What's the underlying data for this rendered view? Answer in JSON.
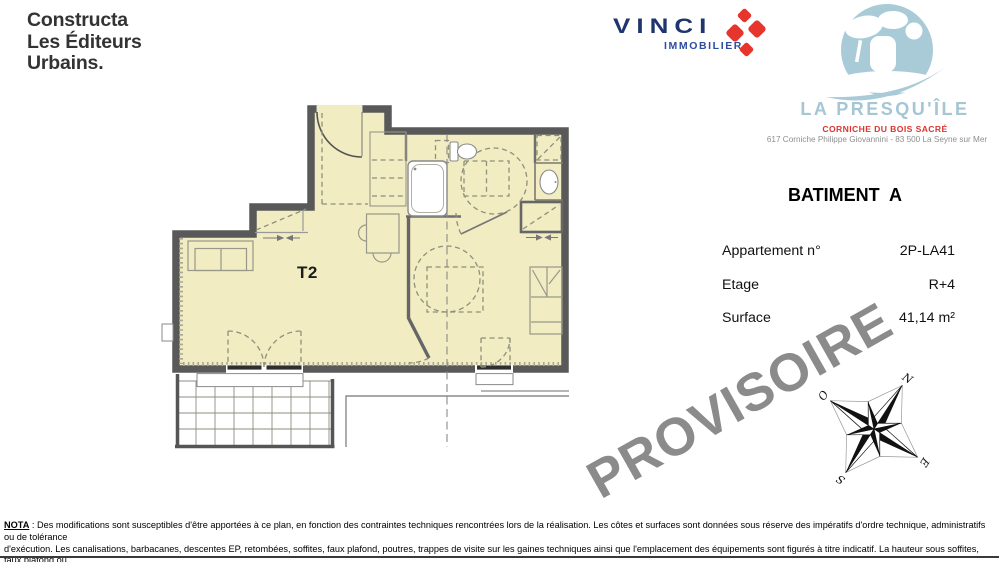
{
  "header": {
    "constructa": {
      "lines": [
        "Constructa",
        "Les Éditeurs",
        "Urbains."
      ]
    },
    "vinci": {
      "name": "VINCI",
      "subtitle": "IMMOBILIER"
    },
    "presquile": {
      "name": "LA PRESQU'ÎLE",
      "tagline": "CORNICHE DU BOIS SACRÉ",
      "address": "617 Corniche Philippe Giovannini - 83 500 La Seyne sur Mer"
    }
  },
  "building": {
    "title": "BATIMENT  A"
  },
  "details": {
    "rows": [
      {
        "label": "Appartement n°",
        "value": "2P-LA41"
      },
      {
        "label": "Etage",
        "value": "R+4"
      },
      {
        "label": "Surface",
        "value": "41,14 m²"
      }
    ]
  },
  "plan": {
    "unit_label": "T2"
  },
  "watermark": {
    "text": "PROVISOIRE"
  },
  "compass": {
    "n": "N",
    "e": "E",
    "s": "S",
    "o": "O"
  },
  "nota": {
    "label": "NOTA",
    "line1": " : Des modifications sont susceptibles d'être apportées à ce plan, en fonction des contraintes techniques rencontrées lors de la réalisation. Les côtes et surfaces sont données sous réserve des impératifs d'ordre technique, administratifs ou de tolérance",
    "line2": "d'exécution. Les canalisations, barbacanes, descentes EP, retombées, soffites, faux plafond, poutres, trappes de visite sur les gaines techniques ainsi que l'emplacement des équipements sont figurés à titre indicatif. La hauteur sous soffites, faux plafond ou",
    "line3": "poutres est de 2 mètres minimum."
  },
  "colors": {
    "floor": "#f1ecc1",
    "wall": "#595959",
    "logo_blue": "#a9cbd7",
    "vinci_navy": "#1f356e",
    "vinci_red": "#e5352c",
    "accent_red": "#d9352e",
    "watermark_gray": "#8b8b8b"
  }
}
